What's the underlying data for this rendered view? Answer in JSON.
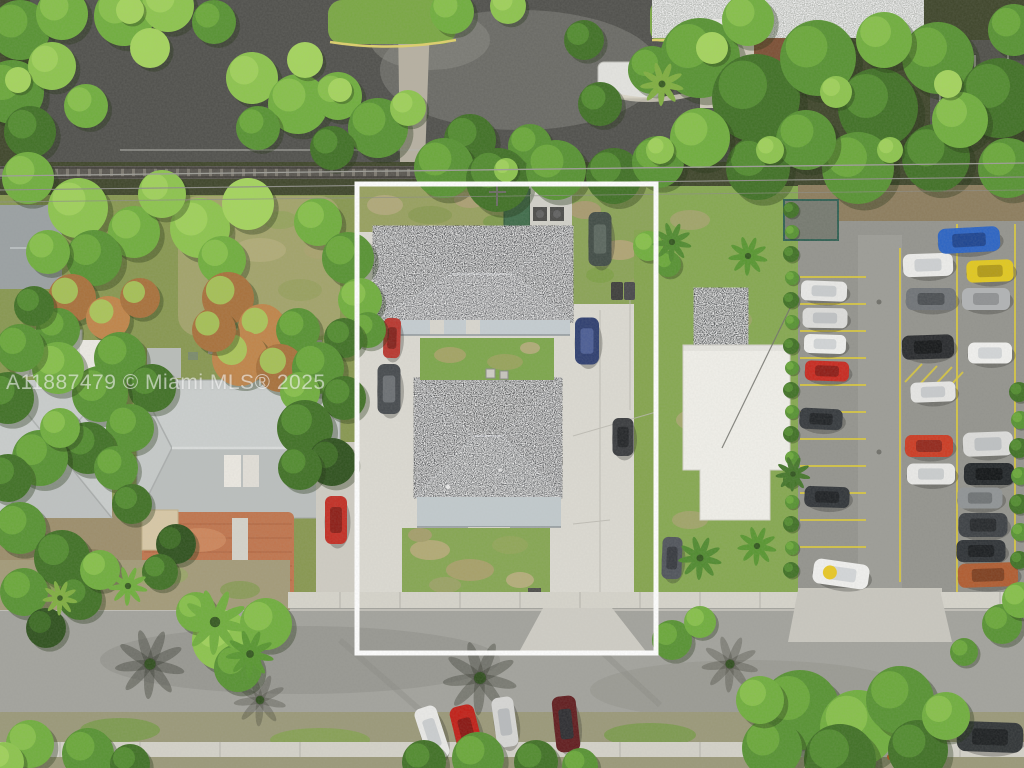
{
  "watermark": {
    "text": "A11887479 © Miami MLS® 2025"
  },
  "scene": {
    "outline": {
      "x": 357,
      "y": 184,
      "w": 299,
      "h": 469,
      "color": "#ffffff",
      "stroke_width": 5
    },
    "palette": {
      "roof_dark": "#5d5f62",
      "roof_porch": "#c5cdd1",
      "white_flat_roof": "#f1f0ea",
      "neighbor_roof": "#c6cac9",
      "concrete": "#dcdad2",
      "street_asphalt": "#a2a29c",
      "lot_asphalt": "#93938d",
      "parking_line_yellow": "#d8c73e",
      "patio_brick": "#c0744c",
      "grass": "#85a651"
    },
    "tree_colors": [
      "#2d501c",
      "#3f7024",
      "#569231",
      "#6fae3c",
      "#8cc44c",
      "#a4d45c",
      "#a8703a",
      "#c08448"
    ],
    "trees": [
      [
        20,
        30,
        30,
        2
      ],
      [
        62,
        14,
        26,
        3
      ],
      [
        12,
        92,
        32,
        2
      ],
      [
        52,
        66,
        24,
        4
      ],
      [
        30,
        132,
        26,
        1
      ],
      [
        86,
        106,
        22,
        3
      ],
      [
        124,
        16,
        30,
        3
      ],
      [
        168,
        6,
        26,
        4
      ],
      [
        214,
        22,
        22,
        2
      ],
      [
        150,
        48,
        20,
        5
      ],
      [
        252,
        78,
        26,
        4
      ],
      [
        298,
        104,
        30,
        3
      ],
      [
        258,
        128,
        22,
        2
      ],
      [
        305,
        60,
        18,
        5
      ],
      [
        338,
        96,
        24,
        3
      ],
      [
        378,
        128,
        30,
        2
      ],
      [
        332,
        148,
        22,
        1
      ],
      [
        408,
        108,
        18,
        4
      ],
      [
        452,
        12,
        22,
        3
      ],
      [
        508,
        6,
        18,
        4
      ],
      [
        470,
        140,
        26,
        1
      ],
      [
        530,
        146,
        22,
        2
      ],
      [
        444,
        168,
        30,
        2
      ],
      [
        498,
        180,
        32,
        1
      ],
      [
        556,
        170,
        30,
        2
      ],
      [
        614,
        176,
        28,
        1
      ],
      [
        658,
        162,
        26,
        2
      ],
      [
        600,
        104,
        22,
        1
      ],
      [
        652,
        70,
        24,
        2
      ],
      [
        584,
        40,
        20,
        1
      ],
      [
        700,
        58,
        40,
        2
      ],
      [
        756,
        98,
        44,
        1
      ],
      [
        818,
        58,
        38,
        2
      ],
      [
        878,
        108,
        40,
        1
      ],
      [
        938,
        58,
        36,
        2
      ],
      [
        1000,
        98,
        40,
        1
      ],
      [
        858,
        168,
        36,
        2
      ],
      [
        936,
        158,
        34,
        1
      ],
      [
        1008,
        168,
        30,
        2
      ],
      [
        758,
        168,
        32,
        1
      ],
      [
        700,
        138,
        30,
        3
      ],
      [
        806,
        140,
        30,
        2
      ],
      [
        960,
        120,
        28,
        3
      ],
      [
        884,
        40,
        28,
        3
      ],
      [
        1014,
        30,
        26,
        2
      ],
      [
        748,
        20,
        26,
        3
      ],
      [
        712,
        48,
        16,
        5
      ],
      [
        836,
        92,
        16,
        4
      ],
      [
        948,
        84,
        14,
        5
      ],
      [
        770,
        150,
        14,
        4
      ],
      [
        660,
        150,
        14,
        4
      ],
      [
        890,
        150,
        13,
        4
      ],
      [
        506,
        170,
        12,
        4
      ],
      [
        340,
        90,
        12,
        5
      ],
      [
        18,
        80,
        13,
        5
      ],
      [
        130,
        10,
        14,
        5
      ],
      [
        28,
        178,
        26,
        3
      ],
      [
        78,
        208,
        30,
        4
      ],
      [
        134,
        232,
        26,
        3
      ],
      [
        94,
        258,
        28,
        2
      ],
      [
        48,
        252,
        22,
        3
      ],
      [
        72,
        298,
        24,
        6
      ],
      [
        108,
        318,
        22,
        7
      ],
      [
        140,
        298,
        20,
        6
      ],
      [
        58,
        330,
        22,
        2
      ],
      [
        34,
        306,
        20,
        1
      ],
      [
        200,
        228,
        30,
        4
      ],
      [
        248,
        204,
        26,
        5
      ],
      [
        162,
        194,
        24,
        4
      ],
      [
        222,
        260,
        24,
        3
      ],
      [
        318,
        222,
        24,
        3
      ],
      [
        348,
        258,
        26,
        2
      ],
      [
        360,
        300,
        22,
        3
      ],
      [
        368,
        330,
        18,
        2
      ],
      [
        344,
        338,
        20,
        1
      ],
      [
        228,
        298,
        26,
        6
      ],
      [
        262,
        328,
        24,
        7
      ],
      [
        298,
        330,
        22,
        2
      ],
      [
        240,
        358,
        28,
        7
      ],
      [
        280,
        368,
        24,
        6
      ],
      [
        214,
        330,
        22,
        6
      ],
      [
        318,
        368,
        26,
        2
      ],
      [
        344,
        398,
        22,
        1
      ],
      [
        300,
        392,
        20,
        3
      ],
      [
        120,
        358,
        26,
        2
      ],
      [
        152,
        388,
        24,
        1
      ],
      [
        100,
        394,
        28,
        2
      ],
      [
        58,
        368,
        26,
        3
      ],
      [
        20,
        348,
        24,
        2
      ],
      [
        8,
        398,
        26,
        1
      ],
      [
        130,
        428,
        24,
        2
      ],
      [
        88,
        448,
        26,
        1
      ],
      [
        40,
        458,
        28,
        2
      ],
      [
        8,
        478,
        24,
        1
      ],
      [
        60,
        428,
        20,
        3
      ],
      [
        116,
        468,
        22,
        2
      ],
      [
        132,
        504,
        20,
        1
      ],
      [
        20,
        528,
        26,
        2
      ],
      [
        62,
        558,
        28,
        1
      ],
      [
        24,
        592,
        24,
        2
      ],
      [
        80,
        598,
        22,
        1
      ],
      [
        46,
        628,
        20,
        0
      ],
      [
        100,
        570,
        20,
        3
      ],
      [
        305,
        428,
        28,
        1
      ],
      [
        332,
        462,
        24,
        0
      ],
      [
        300,
        468,
        22,
        1
      ],
      [
        176,
        544,
        20,
        0
      ],
      [
        160,
        572,
        18,
        1
      ],
      [
        648,
        246,
        15,
        3
      ],
      [
        668,
        264,
        13,
        2
      ],
      [
        672,
        640,
        20,
        2
      ],
      [
        700,
        622,
        16,
        3
      ],
      [
        791,
        210,
        8,
        1
      ],
      [
        792,
        232,
        7,
        2
      ],
      [
        791,
        254,
        8,
        1
      ],
      [
        792,
        278,
        7,
        2
      ],
      [
        791,
        300,
        8,
        1
      ],
      [
        792,
        322,
        7,
        2
      ],
      [
        791,
        346,
        8,
        1
      ],
      [
        792,
        368,
        7,
        2
      ],
      [
        791,
        390,
        8,
        1
      ],
      [
        792,
        412,
        7,
        2
      ],
      [
        791,
        434,
        8,
        1
      ],
      [
        792,
        458,
        7,
        2
      ],
      [
        791,
        480,
        8,
        1
      ],
      [
        792,
        502,
        7,
        2
      ],
      [
        791,
        524,
        8,
        1
      ],
      [
        792,
        548,
        7,
        2
      ],
      [
        791,
        570,
        8,
        1
      ],
      [
        1019,
        392,
        10,
        1
      ],
      [
        1020,
        420,
        9,
        2
      ],
      [
        1019,
        448,
        10,
        1
      ],
      [
        1020,
        476,
        9,
        2
      ],
      [
        1019,
        504,
        10,
        1
      ],
      [
        1020,
        532,
        9,
        2
      ],
      [
        1019,
        560,
        9,
        1
      ],
      [
        222,
        640,
        30,
        4
      ],
      [
        266,
        624,
        26,
        3
      ],
      [
        238,
        668,
        24,
        2
      ],
      [
        196,
        612,
        20,
        3
      ],
      [
        30,
        744,
        24,
        3
      ],
      [
        88,
        754,
        26,
        2
      ],
      [
        4,
        762,
        20,
        4
      ],
      [
        130,
        764,
        20,
        1
      ],
      [
        424,
        762,
        22,
        1
      ],
      [
        478,
        758,
        26,
        2
      ],
      [
        536,
        762,
        22,
        1
      ],
      [
        580,
        766,
        18,
        2
      ],
      [
        800,
        710,
        40,
        2
      ],
      [
        858,
        728,
        38,
        3
      ],
      [
        900,
        700,
        34,
        2
      ],
      [
        840,
        760,
        36,
        1
      ],
      [
        772,
        748,
        30,
        2
      ],
      [
        918,
        750,
        30,
        1
      ],
      [
        946,
        716,
        24,
        3
      ],
      [
        760,
        700,
        24,
        3
      ],
      [
        1002,
        624,
        20,
        2
      ],
      [
        1020,
        600,
        18,
        3
      ],
      [
        964,
        652,
        14,
        2
      ]
    ],
    "palms": [
      [
        662,
        84,
        1.0,
        "#7fae3f"
      ],
      [
        672,
        242,
        0.9,
        "#4f8a2e"
      ],
      [
        748,
        256,
        0.9,
        "#57962f"
      ],
      [
        700,
        558,
        1.0,
        "#4f8a2e"
      ],
      [
        757,
        546,
        0.9,
        "#57962f"
      ],
      [
        793,
        474,
        0.8,
        "#44762a"
      ],
      [
        215,
        622,
        1.5,
        "#6fae3c"
      ],
      [
        250,
        654,
        1.1,
        "#57962f"
      ],
      [
        128,
        586,
        0.9,
        "#6fae3c"
      ],
      [
        60,
        598,
        0.8,
        "#7fae3f"
      ]
    ],
    "shadows": [
      [
        150,
        664,
        1.6,
        "rgba(52,54,44,0.40)"
      ],
      [
        480,
        678,
        1.7,
        "rgba(52,54,44,0.38)"
      ],
      [
        730,
        664,
        1.3,
        "rgba(52,54,44,0.30)"
      ],
      [
        260,
        700,
        1.2,
        "rgba(52,54,44,0.30)"
      ]
    ],
    "cars": [
      [
        824,
        291,
        46,
        20,
        2,
        "#e9e9e7",
        "#c9ccce",
        0
      ],
      [
        825,
        318,
        45,
        20,
        1,
        "#dddddb",
        "#bfc2c4",
        0
      ],
      [
        825,
        344,
        42,
        19,
        2,
        "#f0f0ee",
        "#d2d5d7",
        0
      ],
      [
        827,
        371,
        44,
        20,
        2,
        "#c8281e",
        "#8e1a14",
        0
      ],
      [
        821,
        419,
        43,
        21,
        3,
        "#34383c",
        "#1e2124",
        0
      ],
      [
        827,
        497,
        45,
        21,
        2,
        "#2f3337",
        "#1c1f22",
        0
      ],
      [
        841,
        574,
        56,
        25,
        8,
        "#f1f1ef",
        "#d4d7d9",
        1
      ],
      [
        928,
        265,
        50,
        23,
        -2,
        "#ededeb",
        "#ced1d3",
        0
      ],
      [
        931,
        299,
        50,
        22,
        0,
        "#6f7377",
        "#4a4e52",
        0
      ],
      [
        928,
        347,
        52,
        24,
        -2,
        "#27292c",
        "#141618",
        0
      ],
      [
        933,
        392,
        45,
        20,
        -2,
        "#e7e7e5",
        "#c8cbcd",
        0
      ],
      [
        929,
        446,
        48,
        22,
        0,
        "#cc3a22",
        "#93261a",
        0
      ],
      [
        931,
        474,
        48,
        21,
        0,
        "#eaeae8",
        "#cbcecf",
        0
      ],
      [
        969,
        240,
        62,
        25,
        -3,
        "#2a63c4",
        "#1b4390",
        0
      ],
      [
        990,
        271,
        47,
        22,
        -2,
        "#e2c81e",
        "#b29a14",
        0
      ],
      [
        986,
        299,
        48,
        22,
        0,
        "#b1b3b5",
        "#8f9193",
        0
      ],
      [
        990,
        353,
        44,
        21,
        0,
        "#f1f1ef",
        "#d3d6d8",
        0
      ],
      [
        988,
        444,
        50,
        24,
        -2,
        "#dddddb",
        "#bec1c3",
        0
      ],
      [
        989,
        474,
        50,
        22,
        0,
        "#212528",
        "#101315",
        0
      ],
      [
        980,
        498,
        45,
        21,
        0,
        "#8f9395",
        "#6e7274",
        0
      ],
      [
        983,
        525,
        49,
        24,
        0,
        "#3b3f43",
        "#24272a",
        0
      ],
      [
        981,
        551,
        49,
        22,
        0,
        "#2d3135",
        "#191c1f",
        0
      ],
      [
        988,
        575,
        60,
        24,
        -2,
        "#b05b2f",
        "#7e3e1e",
        0
      ],
      [
        432,
        733,
        23,
        54,
        -18,
        "#eaeae8",
        "#cbced0",
        0
      ],
      [
        467,
        733,
        25,
        56,
        -14,
        "#c11e16",
        "#891410",
        0
      ],
      [
        505,
        722,
        22,
        50,
        -8,
        "#d7d7d5",
        "#b8bbbd",
        0
      ],
      [
        566,
        724,
        24,
        56,
        -6,
        "#601b1d",
        "#2c2c30",
        0
      ],
      [
        805,
        734,
        56,
        26,
        4,
        "#e5e5e3",
        "#c6c9cb",
        0
      ],
      [
        990,
        737,
        66,
        30,
        2,
        "#2f3335",
        "#1b1e20",
        0
      ],
      [
        392,
        338,
        17,
        40,
        2,
        "#b9352d",
        "#83201a",
        0
      ],
      [
        389,
        389,
        23,
        50,
        0,
        "#45494d",
        "#6b6f73",
        0
      ],
      [
        587,
        341,
        24,
        47,
        0,
        "#2d3d6f",
        "#4a5c94",
        0
      ],
      [
        600,
        239,
        23,
        54,
        0,
        "#404b45",
        "#5a665e",
        0
      ],
      [
        623,
        437,
        21,
        38,
        0,
        "#383a3d",
        "#222427",
        0
      ],
      [
        672,
        558,
        20,
        42,
        2,
        "#4f535a",
        "#35383e",
        0
      ],
      [
        336,
        520,
        22,
        48,
        0,
        "#c32d23",
        "#8c1c15",
        0
      ]
    ],
    "cones": [
      [
        22,
        731
      ],
      [
        948,
        713
      ],
      [
        933,
        748
      ],
      [
        890,
        757
      ]
    ]
  }
}
